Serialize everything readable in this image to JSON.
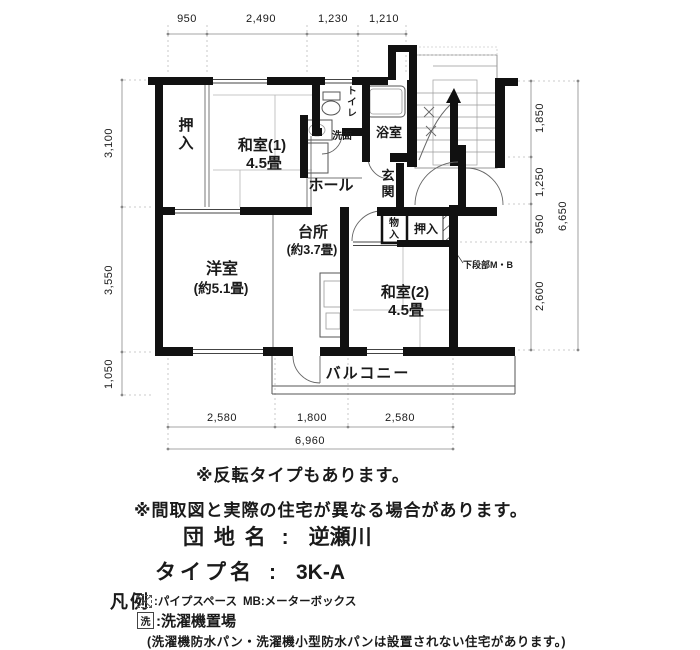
{
  "plan": {
    "rooms": {
      "oshiire1": "押入",
      "washitsu1_name": "和室(1)",
      "washitsu1_size": "4.5畳",
      "toilet": "トイレ",
      "senmen": "洗面",
      "bath": "浴室",
      "genkan": "玄関",
      "hall": "ホール",
      "daidokoro_name": "台所",
      "daidokoro_size": "(約3.7畳)",
      "monoire": "物入",
      "oshiire2": "押入",
      "kadanbu": "下段部M・B",
      "yoshitsu_name": "洋室",
      "yoshitsu_size": "(約5.1畳)",
      "washitsu2_name": "和室(2)",
      "washitsu2_size": "4.5畳",
      "balcony": "バルコニー"
    },
    "dims": {
      "top": [
        "950",
        "2,490",
        "1,230",
        "1,210"
      ],
      "left": [
        "3,100",
        "3,550",
        "1,050"
      ],
      "right": [
        "1,850",
        "1,250",
        "950",
        "2,600"
      ],
      "right_total": "6,650",
      "bottom": [
        "2,580",
        "1,800",
        "2,580"
      ],
      "bottom_total": "6,960"
    }
  },
  "notes": {
    "note1": "※反転タイプもあります。",
    "note2": "※間取図と実際の住宅が異なる場合があります。"
  },
  "info": {
    "danchi_label": "団 地 名",
    "danchi_sep": ":",
    "danchi_value": "逆瀬川",
    "type_label": "タイプ名",
    "type_sep": ":",
    "type_value": "3K-A"
  },
  "legend": {
    "title": "凡例",
    "ps_text": ":パイプスペース",
    "mb_text": "MB:メーターボックス",
    "wash_symbol": "洗",
    "wash_text": ":洗濯機置場",
    "note": "(洗濯機防水パン・洗濯機小型防水パンは設置されない住宅があります。)"
  }
}
